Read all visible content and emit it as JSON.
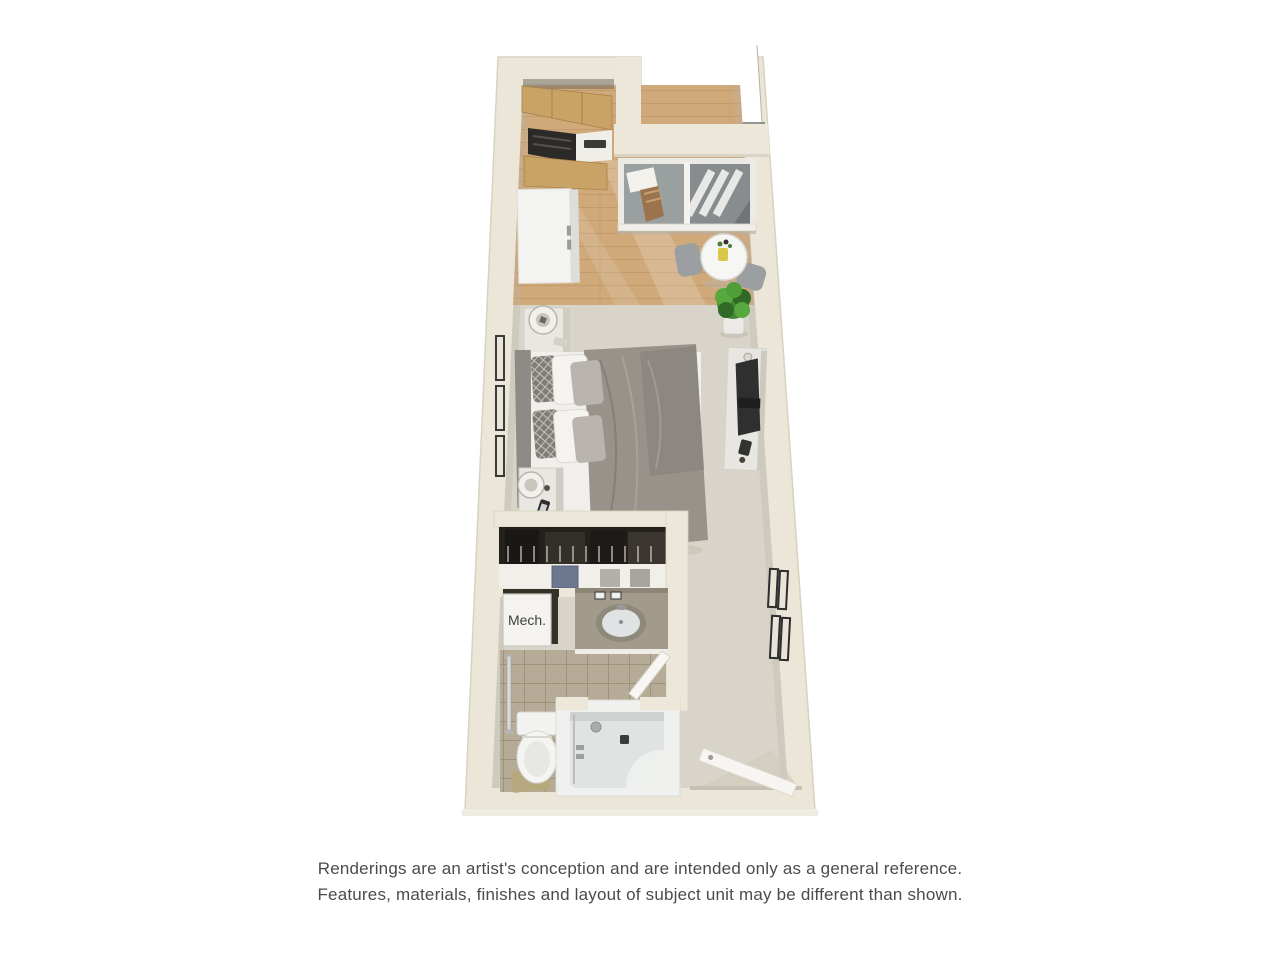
{
  "floorplan": {
    "mech_label": "Mech.",
    "colors": {
      "wall": "#ebe6d7",
      "wall_edge": "#d8d2c2",
      "carpet": "#d9d4c9",
      "wood_floor": "#d0a97a",
      "tile_floor": "#b6ab96",
      "cabinet_wood": "#c9a265",
      "appliance_dark": "#2b2a28",
      "fixture_white": "#f3f3f1",
      "bedding_gray": "#98928b",
      "glass_gray": "#8b9193",
      "closet_dark": "#24211d",
      "plant_green": "#3f8a33",
      "text_dark": "#4b4b4b"
    },
    "features": [
      "kitchen-upper-cabinets",
      "range",
      "kitchen-counter",
      "kitchen-lower-cabinets",
      "refrigerator",
      "balcony",
      "sliding-glass-door",
      "dining-table",
      "dining-chairs",
      "flower-vase",
      "potted-plant",
      "bed",
      "headboard",
      "pillows",
      "duvet",
      "nightstand",
      "table-lamp",
      "smartphone",
      "tv-console",
      "television",
      "wall-picture-frames",
      "closet-clothes-rod",
      "closet-shelf",
      "storage-boxes",
      "mechanical-closet",
      "bathroom-vanity",
      "vanity-lights",
      "sink",
      "bathroom-door",
      "grab-bar",
      "toilet",
      "bath-mat",
      "bathtub-shower",
      "entry-door"
    ]
  },
  "disclaimer": {
    "line1": "Renderings are an artist's conception and are intended only as a general reference.",
    "line2": "Features, materials, finishes and layout of subject unit may be different than shown."
  }
}
